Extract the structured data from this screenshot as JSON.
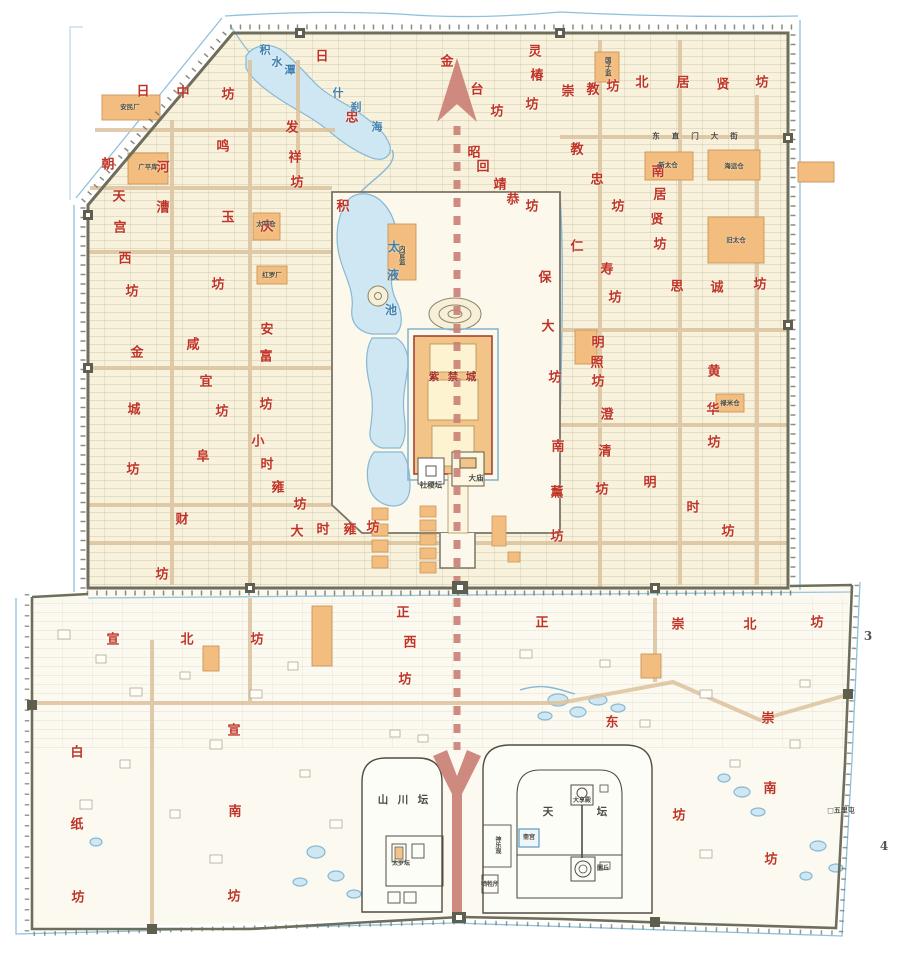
{
  "palette": {
    "ward_red": "#c03425",
    "water_blue": "#3f7fae",
    "ink": "#4c4a3f",
    "dim": "#55554e",
    "accent_orange": "#f2bd7e",
    "orange_edge": "#c9955a",
    "axis_rose": "#cb8076",
    "wall_olive": "#6e6e5c",
    "moat_blue": "#8fc1da",
    "lake_fill": "#cfe7f3",
    "ground_cream": "#f8f2dc",
    "fc_red": "#a83326"
  },
  "wards": [
    {
      "n": "日中坊",
      "c": [
        [
          143,
          92,
          "日"
        ],
        [
          183,
          93,
          "中"
        ],
        [
          228,
          95,
          "坊"
        ]
      ]
    },
    {
      "n": "日忠坊",
      "c": [
        [
          322,
          57,
          "日"
        ],
        [
          352,
          118,
          "忠"
        ]
      ]
    },
    {
      "n": "金台坊",
      "c": [
        [
          447,
          62,
          "金"
        ],
        [
          477,
          90,
          "台"
        ],
        [
          497,
          112,
          "坊"
        ]
      ]
    },
    {
      "n": "灵椿坊",
      "c": [
        [
          535,
          52,
          "灵"
        ],
        [
          537,
          76,
          "椿"
        ],
        [
          532,
          105,
          "坊"
        ]
      ]
    },
    {
      "n": "崇教坊",
      "c": [
        [
          568,
          92,
          "崇"
        ],
        [
          593,
          90,
          "教"
        ],
        [
          613,
          87,
          "坊"
        ]
      ]
    },
    {
      "n": "北居贤坊",
      "c": [
        [
          642,
          83,
          "北"
        ],
        [
          683,
          83,
          "居"
        ],
        [
          723,
          85,
          "贤"
        ],
        [
          762,
          83,
          "坊"
        ]
      ]
    },
    {
      "n": "发祥坊",
      "c": [
        [
          292,
          128,
          "发"
        ],
        [
          295,
          158,
          "祥"
        ],
        [
          297,
          183,
          "坊"
        ]
      ]
    },
    {
      "n": "昭回靖恭坊",
      "c": [
        [
          474,
          153,
          "昭"
        ],
        [
          483,
          167,
          "回"
        ],
        [
          500,
          185,
          "靖"
        ],
        [
          513,
          200,
          "恭"
        ],
        [
          532,
          207,
          "坊"
        ]
      ]
    },
    {
      "n": "教忠坊",
      "c": [
        [
          577,
          150,
          "教"
        ],
        [
          597,
          180,
          "忠"
        ],
        [
          618,
          207,
          "坊"
        ]
      ]
    },
    {
      "n": "南居贤坊",
      "c": [
        [
          658,
          172,
          "南"
        ],
        [
          660,
          195,
          "居"
        ],
        [
          657,
          220,
          "贤"
        ],
        [
          660,
          245,
          "坊"
        ]
      ]
    },
    {
      "n": "河漕",
      "c": [
        [
          163,
          168,
          "河"
        ],
        [
          163,
          208,
          "漕"
        ]
      ]
    },
    {
      "n": "朝天宫西坊",
      "c": [
        [
          108,
          165,
          "朝"
        ],
        [
          119,
          197,
          "天"
        ],
        [
          120,
          228,
          "宫"
        ],
        [
          125,
          259,
          "西"
        ],
        [
          132,
          292,
          "坊"
        ]
      ]
    },
    {
      "n": "鸣玉坊",
      "c": [
        [
          223,
          147,
          "鸣"
        ],
        [
          228,
          218,
          "玉"
        ],
        [
          218,
          285,
          "坊"
        ]
      ]
    },
    {
      "n": "积庆坊",
      "c": [
        [
          343,
          207,
          "积"
        ],
        [
          267,
          227,
          "庆"
        ]
      ]
    },
    {
      "n": "安富坊",
      "c": [
        [
          267,
          330,
          "安"
        ],
        [
          266,
          357,
          "富"
        ],
        [
          266,
          405,
          "坊"
        ]
      ]
    },
    {
      "n": "咸宜坊",
      "c": [
        [
          193,
          345,
          "咸"
        ],
        [
          206,
          382,
          "宜"
        ],
        [
          222,
          412,
          "坊"
        ]
      ]
    },
    {
      "n": "金城坊",
      "c": [
        [
          137,
          353,
          "金"
        ],
        [
          134,
          410,
          "城"
        ],
        [
          133,
          470,
          "坊"
        ]
      ]
    },
    {
      "n": "小时雍坊",
      "c": [
        [
          258,
          442,
          "小"
        ],
        [
          267,
          465,
          "时"
        ],
        [
          278,
          488,
          "雍"
        ],
        [
          300,
          505,
          "坊"
        ]
      ]
    },
    {
      "n": "大时雍坊",
      "c": [
        [
          297,
          532,
          "大"
        ],
        [
          323,
          530,
          "时"
        ],
        [
          350,
          530,
          "雍"
        ],
        [
          373,
          528,
          "坊"
        ]
      ]
    },
    {
      "n": "阜财坊",
      "c": [
        [
          203,
          457,
          "阜"
        ],
        [
          182,
          520,
          "财"
        ],
        [
          162,
          575,
          "坊"
        ]
      ]
    },
    {
      "n": "保大坊",
      "c": [
        [
          545,
          278,
          "保"
        ],
        [
          548,
          327,
          "大"
        ],
        [
          555,
          378,
          "坊"
        ]
      ]
    },
    {
      "n": "仁寿坊",
      "c": [
        [
          577,
          247,
          "仁"
        ],
        [
          607,
          270,
          "寿"
        ],
        [
          615,
          298,
          "坊"
        ]
      ]
    },
    {
      "n": "明照坊",
      "c": [
        [
          598,
          343,
          "明"
        ],
        [
          597,
          363,
          "照"
        ],
        [
          598,
          382,
          "坊"
        ]
      ]
    },
    {
      "n": "思诚坊",
      "c": [
        [
          677,
          287,
          "思"
        ],
        [
          717,
          288,
          "诚"
        ],
        [
          760,
          285,
          "坊"
        ]
      ]
    },
    {
      "n": "澄清坊",
      "c": [
        [
          607,
          415,
          "澄"
        ],
        [
          605,
          452,
          "清"
        ],
        [
          602,
          490,
          "坊"
        ]
      ]
    },
    {
      "n": "黄华坊",
      "c": [
        [
          714,
          372,
          "黄"
        ],
        [
          713,
          410,
          "华"
        ],
        [
          714,
          443,
          "坊"
        ]
      ]
    },
    {
      "n": "南薰坊",
      "c": [
        [
          558,
          447,
          "南"
        ],
        [
          557,
          493,
          "薰"
        ],
        [
          557,
          537,
          "坊"
        ]
      ]
    },
    {
      "n": "明时坊",
      "c": [
        [
          650,
          483,
          "明"
        ],
        [
          693,
          508,
          "时"
        ],
        [
          728,
          532,
          "坊"
        ]
      ]
    },
    {
      "n": "宣北坊",
      "c": [
        [
          113,
          640,
          "宣"
        ],
        [
          187,
          640,
          "北"
        ],
        [
          257,
          640,
          "坊"
        ]
      ]
    },
    {
      "n": "宣南坊",
      "c": [
        [
          234,
          731,
          "宣"
        ],
        [
          235,
          812,
          "南"
        ],
        [
          234,
          897,
          "坊"
        ]
      ]
    },
    {
      "n": "白纸坊",
      "c": [
        [
          77,
          753,
          "白"
        ],
        [
          77,
          825,
          "纸"
        ],
        [
          78,
          898,
          "坊"
        ]
      ]
    },
    {
      "n": "正西坊",
      "c": [
        [
          403,
          613,
          "正"
        ],
        [
          410,
          643,
          "西"
        ],
        [
          405,
          680,
          "坊"
        ]
      ]
    },
    {
      "n": "正东坊",
      "c": [
        [
          542,
          623,
          "正"
        ],
        [
          612,
          723,
          "东"
        ],
        [
          679,
          816,
          "坊"
        ]
      ]
    },
    {
      "n": "崇北坊",
      "c": [
        [
          678,
          625,
          "崇"
        ],
        [
          750,
          625,
          "北"
        ],
        [
          817,
          623,
          "坊"
        ]
      ]
    },
    {
      "n": "崇南坊",
      "c": [
        [
          768,
          719,
          "崇"
        ],
        [
          770,
          789,
          "南"
        ],
        [
          771,
          860,
          "坊"
        ]
      ]
    }
  ],
  "labels": [
    {
      "nm": "lake-label-jishuitan",
      "col": "water_blue",
      "s": 11,
      "cs": [
        [
          265,
          50,
          "积"
        ],
        [
          277,
          62,
          "水"
        ],
        [
          290,
          70,
          "潭"
        ]
      ]
    },
    {
      "nm": "lake-label-shichahai",
      "col": "water_blue",
      "s": 11,
      "cs": [
        [
          338,
          93,
          "什"
        ],
        [
          356,
          107,
          "刹"
        ],
        [
          377,
          127,
          "海"
        ]
      ]
    },
    {
      "nm": "lake-label-taiyechi",
      "col": "water_blue",
      "s": 12,
      "cs": [
        [
          394,
          247,
          "太"
        ],
        [
          393,
          275,
          "液"
        ],
        [
          391,
          310,
          "池"
        ]
      ]
    },
    {
      "nm": "street-label-dongzhimen",
      "t": "东直门大街",
      "x": 701,
      "y": 136,
      "s": 7.5,
      "col": "ink",
      "ls": 12
    },
    {
      "nm": "forbidden-city-label",
      "col": "fc_red",
      "s": 10.5,
      "cs": [
        [
          434,
          377,
          "紫"
        ],
        [
          453,
          377,
          "禁"
        ],
        [
          471,
          377,
          "城"
        ]
      ]
    },
    {
      "nm": "sheji-altar-label",
      "t": "社稷坛",
      "x": 431,
      "y": 485,
      "s": 7.5,
      "col": "ink"
    },
    {
      "nm": "taimiao-label",
      "t": "大庙",
      "x": 476,
      "y": 478,
      "s": 7.5,
      "col": "ink"
    },
    {
      "nm": "shanchuan-altar-label",
      "col": "ink",
      "s": 10.5,
      "cs": [
        [
          383,
          800,
          "山"
        ],
        [
          403,
          800,
          "川"
        ],
        [
          423,
          800,
          "坛"
        ]
      ]
    },
    {
      "nm": "temple-of-heaven-label",
      "col": "ink",
      "s": 10.5,
      "cs": [
        [
          548,
          812,
          "天"
        ],
        [
          602,
          812,
          "坛"
        ]
      ]
    },
    {
      "nm": "daxiangdian-label",
      "t": "大享殿",
      "x": 582,
      "y": 801,
      "s": 6,
      "col": "ink"
    },
    {
      "nm": "zhaigong-label",
      "t": "斋宫",
      "x": 529,
      "y": 838,
      "s": 6,
      "col": "ink"
    },
    {
      "nm": "yuanqiu-label",
      "t": "圜丘",
      "x": 603,
      "y": 869,
      "s": 6,
      "col": "ink"
    },
    {
      "nm": "xishengsuo-label",
      "t": "牺牲所",
      "x": 490,
      "y": 885,
      "s": 6,
      "col": "ink"
    },
    {
      "nm": "shenyueguan-label",
      "t": "神乐观",
      "x": 497,
      "y": 845,
      "s": 6,
      "col": "ink",
      "v": 1
    },
    {
      "nm": "taisui-altar-label",
      "t": "太岁坛",
      "x": 401,
      "y": 864,
      "s": 6,
      "col": "ink"
    },
    {
      "nm": "guozijian-label",
      "t": "国子监",
      "x": 607,
      "y": 66,
      "s": 6.5,
      "col": "ink",
      "v": 1
    },
    {
      "nm": "xintaicang-label",
      "t": "新太仓",
      "x": 668,
      "y": 165,
      "s": 6.5,
      "col": "ink"
    },
    {
      "nm": "haiyuncang-label",
      "t": "海运仓",
      "x": 734,
      "y": 166,
      "s": 6.5,
      "col": "ink"
    },
    {
      "nm": "jiutaicang-label",
      "t": "旧太仓",
      "x": 736,
      "y": 240,
      "s": 6.5,
      "col": "ink"
    },
    {
      "nm": "lumicang-label",
      "t": "禄米仓",
      "x": 730,
      "y": 403,
      "s": 6.5,
      "col": "ink"
    },
    {
      "nm": "anminchang-label",
      "t": "安民厂",
      "x": 130,
      "y": 107,
      "s": 6.5,
      "col": "ink"
    },
    {
      "nm": "guangpingku-label",
      "t": "广平库",
      "x": 148,
      "y": 167,
      "s": 6.5,
      "col": "ink"
    },
    {
      "nm": "taipingcang-label",
      "t": "太平仓",
      "x": 266,
      "y": 224,
      "s": 6.5,
      "col": "ink"
    },
    {
      "nm": "hongluochang-label",
      "t": "红罗厂",
      "x": 272,
      "y": 275,
      "s": 6.5,
      "col": "ink"
    },
    {
      "nm": "neiguanjian-label",
      "t": "内官监",
      "x": 401,
      "y": 255,
      "s": 6.5,
      "col": "ink",
      "v": 1
    },
    {
      "nm": "wulitun-label",
      "t": "□五里屯",
      "x": 841,
      "y": 810,
      "s": 7,
      "col": "ink"
    },
    {
      "nm": "edge-number-3",
      "t": "3",
      "x": 868,
      "y": 636,
      "s": 12,
      "col": "dim"
    },
    {
      "nm": "edge-number-4",
      "t": "4",
      "x": 884,
      "y": 846,
      "s": 12,
      "col": "dim"
    }
  ]
}
